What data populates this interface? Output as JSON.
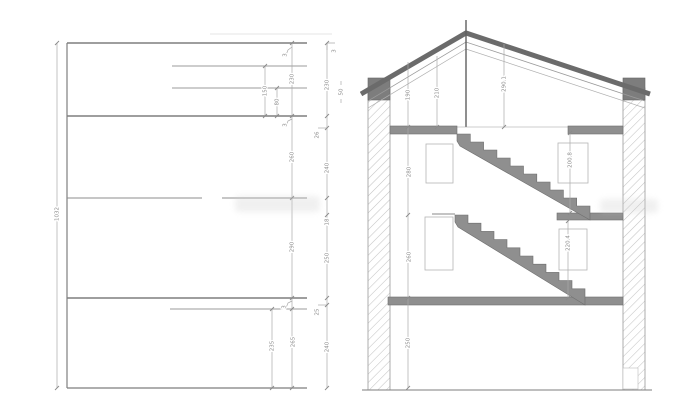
{
  "drawing": {
    "kind": "architectural-section",
    "colors": {
      "line_gray": "#8a8a8a",
      "slab_fill": "#8f8f8f",
      "roof_band": "#6b6b6b",
      "wall_block": "#7d7d7d",
      "hatch": "#c4c4c4"
    }
  },
  "left_elevation": {
    "total_height": "1032",
    "dim_150": "150",
    "dim_80": "80",
    "right_chain": {
      "s1": "230",
      "s2": "260",
      "s3": "290",
      "s4": "265"
    },
    "dim_235": "235",
    "tick_top": "3",
    "tick_mid": "3",
    "tick_low": "3",
    "offset_chain": {
      "tick": "3",
      "s1": "230",
      "j1": "26",
      "s2": "240",
      "s3": "18",
      "s4": "250",
      "j2": "25",
      "s5": "240"
    },
    "note_50": "50"
  },
  "cross_section": {
    "roof_dim_left": "190",
    "roof_dim_mid": "210",
    "roof_dim_ridge": "290.1",
    "floor_chain": {
      "s1": "280",
      "s2": "260",
      "s3": "250"
    },
    "door_upper": "200.8",
    "door_lower": "220.4"
  }
}
